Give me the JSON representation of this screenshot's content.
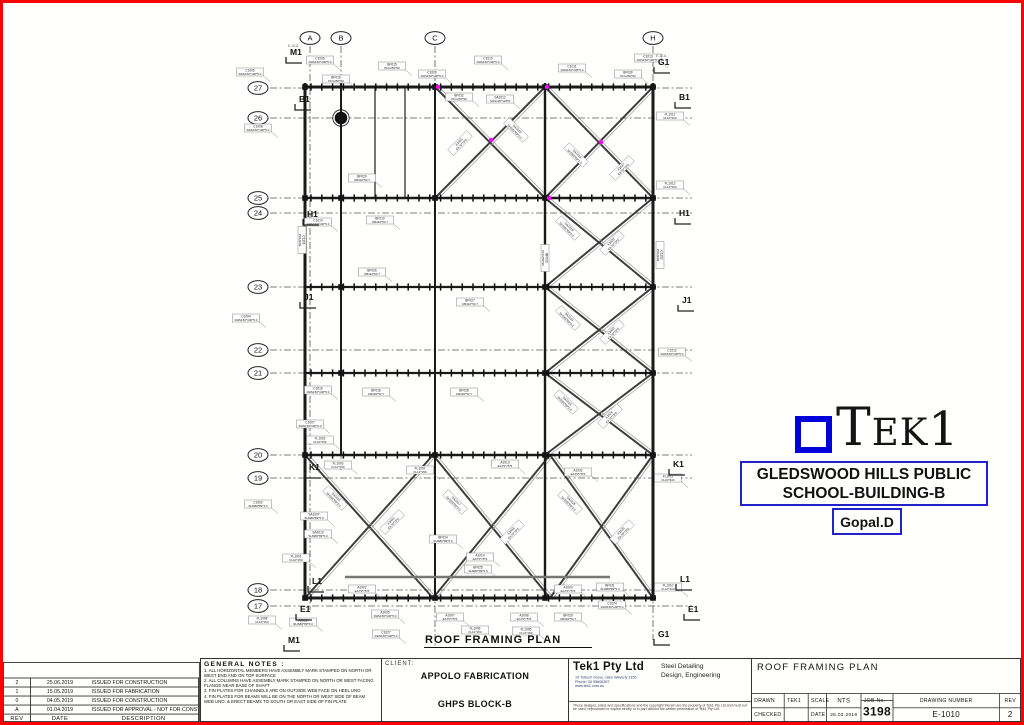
{
  "colors": {
    "page_border": "#ff0000",
    "logo_blue": "#0000dd",
    "box_blue": "#2222cc",
    "magenta": "#ff00ff"
  },
  "logo": {
    "t": "T",
    "ek": "EK",
    "one": "1"
  },
  "project_box": {
    "line1": "GLEDSWOOD HILLS PUBLIC",
    "line2": "SCHOOL-BUILDING-B"
  },
  "author_box": {
    "text": "Gopal.D"
  },
  "revisions": {
    "headers": [
      "REV",
      "DATE",
      "DESCRIPTION"
    ],
    "rows": [
      [
        "2",
        "25.06.2019",
        "ISSUED FOR CONSTRUCTION"
      ],
      [
        "1",
        "15.05.2019",
        "ISSUED FOR FABRICATION"
      ],
      [
        "0",
        "04.05.2019",
        "ISSUED FOR CONSTRUCTION"
      ],
      [
        "A",
        "01.04.2019",
        "ISSUED FOR APPROVAL - NOT FOR CONSTRUCTION"
      ]
    ]
  },
  "general_notes": {
    "title": "GENERAL NOTES :",
    "items": [
      "1. ALL HORIZONTAL MEMBERS HAVE ASSEMBLY MARK STAMPED ON NORTH OR WEST END AND ON TOP SURFACE",
      "2. ALL COLUMNS HAVE ASSEMBLY MARK STAMPED ON NORTH OR WEST FACING FLANGE NEAR BASE OF SHAFT",
      "3. FIN PLATES FOR CHANNELS ARE ON OUTSIDE WEB FACE ON HEEL UNO",
      "4. FIN PLATES FOR BEAMS WILL BE ON THE NORTH OR WEST SIDE OF BEAM WEB UNO. & ERECT BEAMS TO SOUTH OR EAST SIDE OF FIN PLATE"
    ]
  },
  "client": {
    "label": "CLIENT:",
    "name": "APPOLO FABRICATION",
    "project": "GHPS BLOCK-B"
  },
  "company": {
    "name": "Tek1 Pty Ltd",
    "address": "19 Tulloch Grove, Glen Waverly 3150",
    "phone": "Phone: 03 95606397",
    "web": "www.tek1.com.au",
    "services_line1": "Steel Detailing",
    "services_line2": "Design, Engineering",
    "disclaimer": "These designs, plans and specifications and the copyright therein are the property of Tek1 Pty Ltd and must not be used, reproduced or copied wholly or in part without the written permission of Tek1 Pty Ltd."
  },
  "titleblock": {
    "title": "ROOF FRAMING PLAN",
    "drawn_label": "DRAWN",
    "drawn_value": "TEK1",
    "checked_label": "CHECKED",
    "checked_value": "",
    "scale_label": "SCALE",
    "scale_value": "NTS",
    "date_label": "DATE",
    "date_value": "26.03.2019",
    "job_label": "JOB No.",
    "job_value": "3198",
    "dwgnum_label": "DRAWING NUMBER",
    "dwgnum_value": "E-1010",
    "rev_label": "REV",
    "rev_value": "2"
  },
  "plan": {
    "caption": "ROOF FRAMING PLAN",
    "rows": [
      {
        "label": "27",
        "y": 88
      },
      {
        "label": "26",
        "y": 118
      },
      {
        "label": "25",
        "y": 198
      },
      {
        "label": "24",
        "y": 213
      },
      {
        "label": "23",
        "y": 287
      },
      {
        "label": "22",
        "y": 350
      },
      {
        "label": "21",
        "y": 373
      },
      {
        "label": "20",
        "y": 455
      },
      {
        "label": "19",
        "y": 478
      },
      {
        "label": "18",
        "y": 590
      },
      {
        "label": "17",
        "y": 606
      }
    ],
    "cols": [
      {
        "label": "A",
        "x": 310,
        "yend": 610
      },
      {
        "label": "B",
        "x": 341,
        "yend": 470
      },
      {
        "label": "C",
        "x": 435,
        "yend": 648
      },
      {
        "label": "H",
        "x": 653,
        "yend": 640
      }
    ],
    "beams": [
      [
        87,
        305,
        656,
        3
      ],
      [
        198,
        305,
        656,
        2.6
      ],
      [
        287,
        305,
        656,
        2.2
      ],
      [
        373,
        305,
        656,
        2.2
      ],
      [
        455,
        305,
        656,
        2.6
      ],
      [
        598,
        305,
        656,
        3
      ]
    ],
    "aux_beam": [
      577,
      345,
      610
    ],
    "verticals": [
      [
        305,
        83,
        598,
        3
      ],
      [
        341,
        83,
        455,
        2
      ],
      [
        375,
        87,
        198,
        1.2
      ],
      [
        405,
        87,
        198,
        1.2
      ],
      [
        435,
        83,
        598,
        2
      ],
      [
        545,
        83,
        598,
        2.4
      ],
      [
        653,
        83,
        598,
        3
      ]
    ],
    "xbays": [
      [
        435,
        87,
        545,
        198
      ],
      [
        545,
        87,
        653,
        198
      ],
      [
        545,
        198,
        653,
        287
      ],
      [
        545,
        287,
        653,
        373
      ],
      [
        545,
        373,
        653,
        455
      ],
      [
        305,
        455,
        433,
        598
      ],
      [
        433,
        455,
        550,
        598
      ],
      [
        550,
        455,
        653,
        598
      ]
    ],
    "nodes": [
      [
        305,
        87
      ],
      [
        435,
        87
      ],
      [
        545,
        87
      ],
      [
        653,
        87
      ],
      [
        305,
        198
      ],
      [
        341,
        198
      ],
      [
        435,
        198
      ],
      [
        545,
        198
      ],
      [
        653,
        198
      ],
      [
        341,
        287
      ],
      [
        545,
        287
      ],
      [
        653,
        287
      ],
      [
        341,
        373
      ],
      [
        545,
        373
      ],
      [
        653,
        373
      ],
      [
        305,
        455
      ],
      [
        435,
        455
      ],
      [
        545,
        455
      ],
      [
        653,
        455
      ],
      [
        305,
        598
      ],
      [
        435,
        598
      ],
      [
        545,
        598
      ],
      [
        653,
        598
      ]
    ],
    "circle_nodes": [
      [
        341,
        118
      ]
    ],
    "magenta_dots": [
      [
        547,
        87
      ],
      [
        491,
        140
      ],
      [
        601,
        142
      ],
      [
        549,
        198
      ],
      [
        438,
        87
      ]
    ],
    "markers": [
      [
        290,
        52,
        "M1",
        "E-1011"
      ],
      [
        658,
        62,
        "G1",
        "E-1011"
      ],
      [
        299,
        99,
        "B1",
        ""
      ],
      [
        679,
        97,
        "B1",
        ""
      ],
      [
        307,
        214,
        "H1",
        ""
      ],
      [
        679,
        213,
        "H1",
        ""
      ],
      [
        304,
        297,
        "J1",
        ""
      ],
      [
        682,
        300,
        "J1",
        ""
      ],
      [
        309,
        467,
        "K1",
        ""
      ],
      [
        673,
        464,
        "K1",
        ""
      ],
      [
        312,
        581,
        "L1",
        ""
      ],
      [
        680,
        579,
        "L1",
        ""
      ],
      [
        300,
        609,
        "E1",
        ""
      ],
      [
        688,
        609,
        "E1",
        ""
      ],
      [
        288,
        640,
        "M1",
        ""
      ],
      [
        658,
        634,
        "G1",
        ""
      ]
    ],
    "labels": [
      [
        250,
        72,
        "C1005",
        "RHS150*100*5.0",
        0
      ],
      [
        320,
        60,
        "C1006",
        "RHS150*100*5.0",
        0
      ],
      [
        336,
        79,
        "BF016",
        "PFC250*90",
        0
      ],
      [
        392,
        66,
        "BF015",
        "PFC250*90",
        0
      ],
      [
        432,
        74,
        "C1009",
        "RHS150*100*5.0",
        0
      ],
      [
        488,
        60,
        "C1010",
        "RHS150*100*5.0",
        0
      ],
      [
        572,
        68,
        "C1011",
        "RHS150*100*5.0",
        0
      ],
      [
        628,
        74,
        "BF030",
        "PFC250*90",
        0
      ],
      [
        648,
        58,
        "C1013",
        "RHS150*100*5.0",
        0
      ],
      [
        459,
        97,
        "BF032",
        "PFC250*90",
        0
      ],
      [
        500,
        99,
        "SA1012",
        "SHS125*125*8",
        0
      ],
      [
        362,
        178,
        "BF020",
        "UB410*53.7",
        0
      ],
      [
        258,
        128,
        "C1008",
        "RHS150*100*5.0",
        0
      ],
      [
        246,
        318,
        "C1004",
        "RHS150*100*5.0",
        0
      ],
      [
        460,
        143,
        "A1015",
        "EA75*75*6",
        -45
      ],
      [
        516,
        130,
        "SA1016",
        "SHS89*89*5.0",
        45
      ],
      [
        576,
        155,
        "SA1018",
        "SHS89*89*5.0",
        45
      ],
      [
        622,
        168,
        "A1017",
        "EA75*75*6",
        -45
      ],
      [
        670,
        116,
        "FL1012",
        "FL10*200",
        0
      ],
      [
        670,
        185,
        "FL1013",
        "FL10*200",
        0
      ],
      [
        318,
        222,
        "C1014",
        "RHS150*100*5.0",
        0
      ],
      [
        380,
        220,
        "BF019",
        "UB410*53.7",
        0
      ],
      [
        372,
        272,
        "BF026",
        "UB410*53.7",
        0
      ],
      [
        470,
        302,
        "BF027",
        "UB410*53.7",
        0
      ],
      [
        318,
        390,
        "C1016",
        "RHS150*100*5.0",
        0
      ],
      [
        376,
        392,
        "BF018",
        "UB410*53.7",
        0
      ],
      [
        464,
        392,
        "BF028",
        "UB410*53.7",
        0
      ],
      [
        545,
        258,
        "BF033",
        "PFC250*90",
        90
      ],
      [
        568,
        228,
        "SA1019",
        "SHS89*89*5.0",
        45
      ],
      [
        612,
        243,
        "A1020",
        "EA75*75*6",
        -45
      ],
      [
        568,
        318,
        "SA1021",
        "SHS89*89*5.0",
        45
      ],
      [
        612,
        332,
        "A1022",
        "EA75*75*6",
        -45
      ],
      [
        566,
        402,
        "SA1023",
        "SHS89*89*5.0",
        45
      ],
      [
        610,
        416,
        "A1024",
        "EA75*75*6",
        -45
      ],
      [
        302,
        240,
        "C1101",
        "250UC89",
        90
      ],
      [
        660,
        255,
        "C1102",
        "250UC89",
        90
      ],
      [
        672,
        352,
        "C1012",
        "RHS150*100*5.0",
        0
      ],
      [
        310,
        424,
        "C1007",
        "RHS150*100*5.0",
        0
      ],
      [
        320,
        440,
        "FL1002",
        "FL10*150",
        0
      ],
      [
        258,
        504,
        "C1002",
        "SHS89*89*3.5",
        0
      ],
      [
        314,
        516,
        "SA1007",
        "SHS89*89*5.0",
        0
      ],
      [
        318,
        534,
        "SA1013",
        "SHS89*89*5.0",
        0
      ],
      [
        296,
        558,
        "FL1001",
        "FL10*150",
        0
      ],
      [
        338,
        465,
        "FL1003",
        "FL10*150",
        0
      ],
      [
        420,
        470,
        "FL1007",
        "FL12*150",
        0
      ],
      [
        505,
        464,
        "A1013",
        "EA75*75*6",
        0
      ],
      [
        578,
        472,
        "A1032",
        "EA75*75*6",
        0
      ],
      [
        668,
        478,
        "FL1011",
        "FL10*200",
        0
      ],
      [
        335,
        498,
        "SA1015",
        "SHS89*89*5.0",
        45
      ],
      [
        392,
        522,
        "A1016",
        "EA75*75*6",
        -45
      ],
      [
        455,
        502,
        "SA1017",
        "SHS89*89*5.0",
        45
      ],
      [
        512,
        532,
        "A1018",
        "EA75*75*6",
        -45
      ],
      [
        570,
        502,
        "SA1025",
        "SHS89*89*5.0",
        45
      ],
      [
        622,
        532,
        "A1026",
        "EA75*75*6",
        -45
      ],
      [
        443,
        539,
        "BF024",
        "SHS89*89*5.0",
        0
      ],
      [
        480,
        557,
        "A1014",
        "EA75*75*6",
        0
      ],
      [
        478,
        569,
        "BF025",
        "SHS89*89*5.0",
        0
      ],
      [
        362,
        589,
        "A1002",
        "EA75*75*6",
        0
      ],
      [
        568,
        589,
        "A1003",
        "EA75*75*6",
        0
      ],
      [
        610,
        587,
        "BF031",
        "SHS89*89*5.0",
        0
      ],
      [
        668,
        587,
        "FL1010",
        "FL10*200",
        0
      ],
      [
        385,
        614,
        "A1005",
        "RHS150*100*5.0",
        0
      ],
      [
        386,
        634,
        "C1027",
        "RHS150*100*5.0",
        0
      ],
      [
        450,
        617,
        "A1007",
        "EA75*75*6",
        0
      ],
      [
        475,
        630,
        "FL1006",
        "FL12*150",
        0
      ],
      [
        524,
        617,
        "A1008",
        "EA75*75*6",
        0
      ],
      [
        526,
        631,
        "FL1005",
        "FL12*150",
        0
      ],
      [
        568,
        617,
        "BF029",
        "UB410*53.7",
        0
      ],
      [
        612,
        605,
        "C1024",
        "RHS150*100*5.0",
        0
      ],
      [
        262,
        620,
        "FL1008",
        "FL10*150",
        0
      ],
      [
        303,
        622,
        "A1012",
        "RHS89*89*5.0",
        0
      ]
    ]
  }
}
